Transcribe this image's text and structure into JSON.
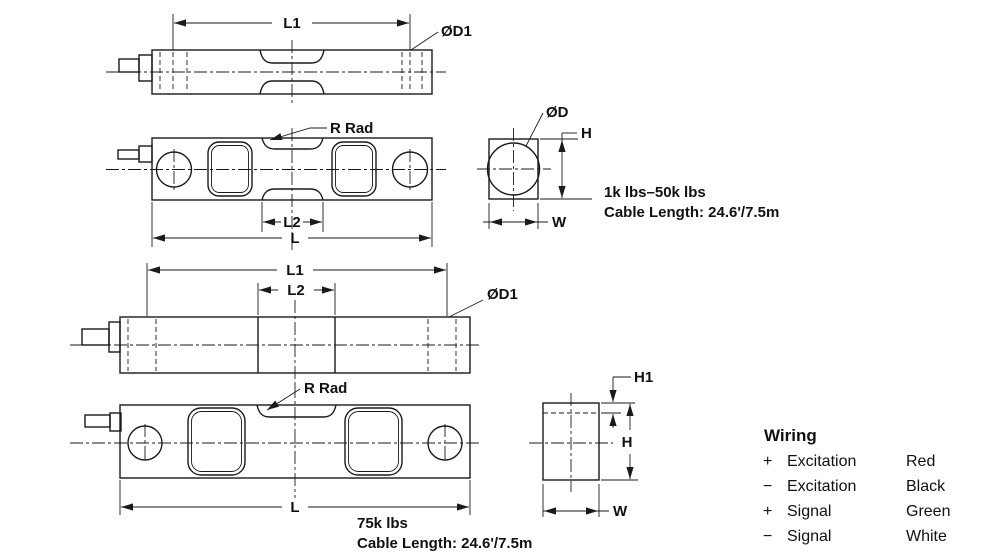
{
  "drawing": {
    "model_small": {
      "top_view": {
        "l1": "L1",
        "d1": "ØD1"
      },
      "side_view": {
        "r_rad": "R Rad",
        "l2": "L2",
        "l": "L"
      },
      "end_view": {
        "d": "ØD",
        "h": "H",
        "w": "W"
      },
      "capacity_note": "1k lbs–50k lbs",
      "cable_note": "Cable Length: 24.6'/7.5m"
    },
    "model_large": {
      "top_view": {
        "l1": "L1",
        "l2": "L2",
        "d1": "ØD1"
      },
      "side_view": {
        "r_rad": "R Rad",
        "l": "L"
      },
      "end_view": {
        "h1": "H1",
        "h": "H",
        "w": "W"
      },
      "capacity_note": "75k lbs",
      "cable_note": "Cable Length: 24.6'/7.5m"
    }
  },
  "wiring": {
    "title": "Wiring",
    "rows": [
      {
        "sign": "+",
        "label": "Excitation",
        "color": "Red"
      },
      {
        "sign": "−",
        "label": "Excitation",
        "color": "Black"
      },
      {
        "sign": "+",
        "label": "Signal",
        "color": "Green"
      },
      {
        "sign": "−",
        "label": "Signal",
        "color": "White"
      }
    ]
  },
  "colors": {
    "line": "#1a1a1a",
    "text": "#111111",
    "background": "#ffffff"
  }
}
